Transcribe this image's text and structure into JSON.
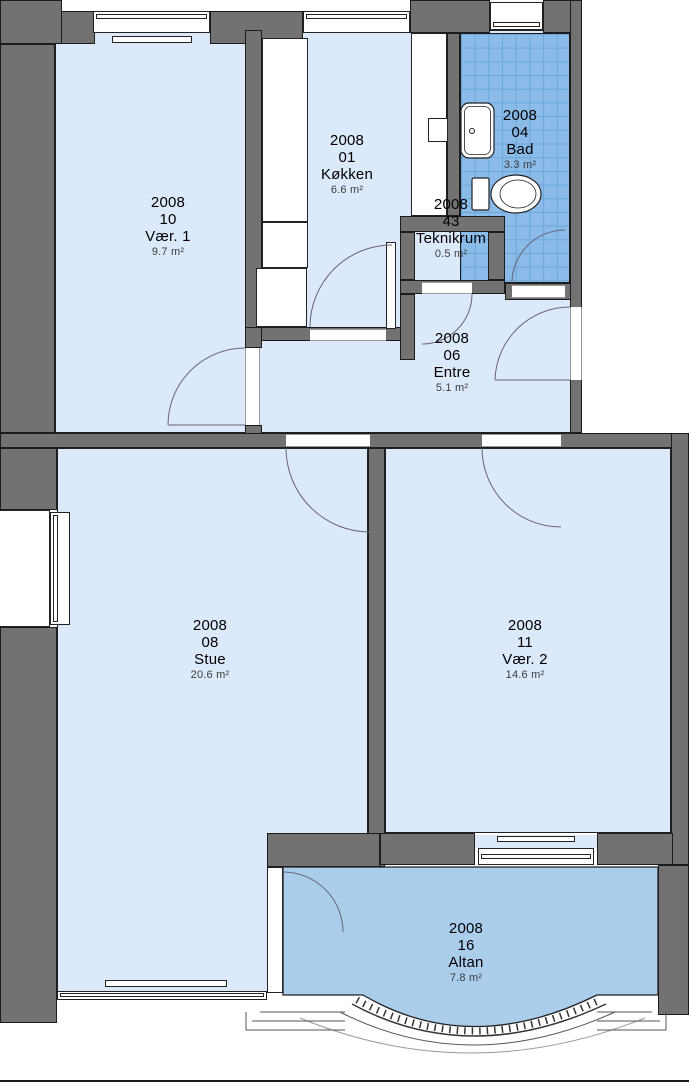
{
  "plan_title": "Apartment floor plan 2008",
  "rooms": {
    "vaer1": {
      "number": "2008",
      "id": "10",
      "name": "Vær. 1",
      "area": "9.7 m²"
    },
    "koekken": {
      "number": "2008",
      "id": "01",
      "name": "Køkken",
      "area": "6.6 m²"
    },
    "bad": {
      "number": "2008",
      "id": "04",
      "name": "Bad",
      "area": "3.3 m²"
    },
    "teknikrum": {
      "number": "2008",
      "id": "43",
      "name": "Teknikrum",
      "area": "0.5 m²"
    },
    "entre": {
      "number": "2008",
      "id": "06",
      "name": "Entre",
      "area": "5.1 m²"
    },
    "stue": {
      "number": "2008",
      "id": "08",
      "name": "Stue",
      "area": "20.6 m²"
    },
    "vaer2": {
      "number": "2008",
      "id": "11",
      "name": "Vær. 2",
      "area": "14.6 m²"
    },
    "altan": {
      "number": "2008",
      "id": "16",
      "name": "Altan",
      "area": "7.8 m²"
    }
  },
  "colors": {
    "room_fill": "#dbe9fa",
    "bath_tile_fill": "#8abbe9",
    "balcony_fill": "#abcdec",
    "wall_fill": "#727272"
  }
}
